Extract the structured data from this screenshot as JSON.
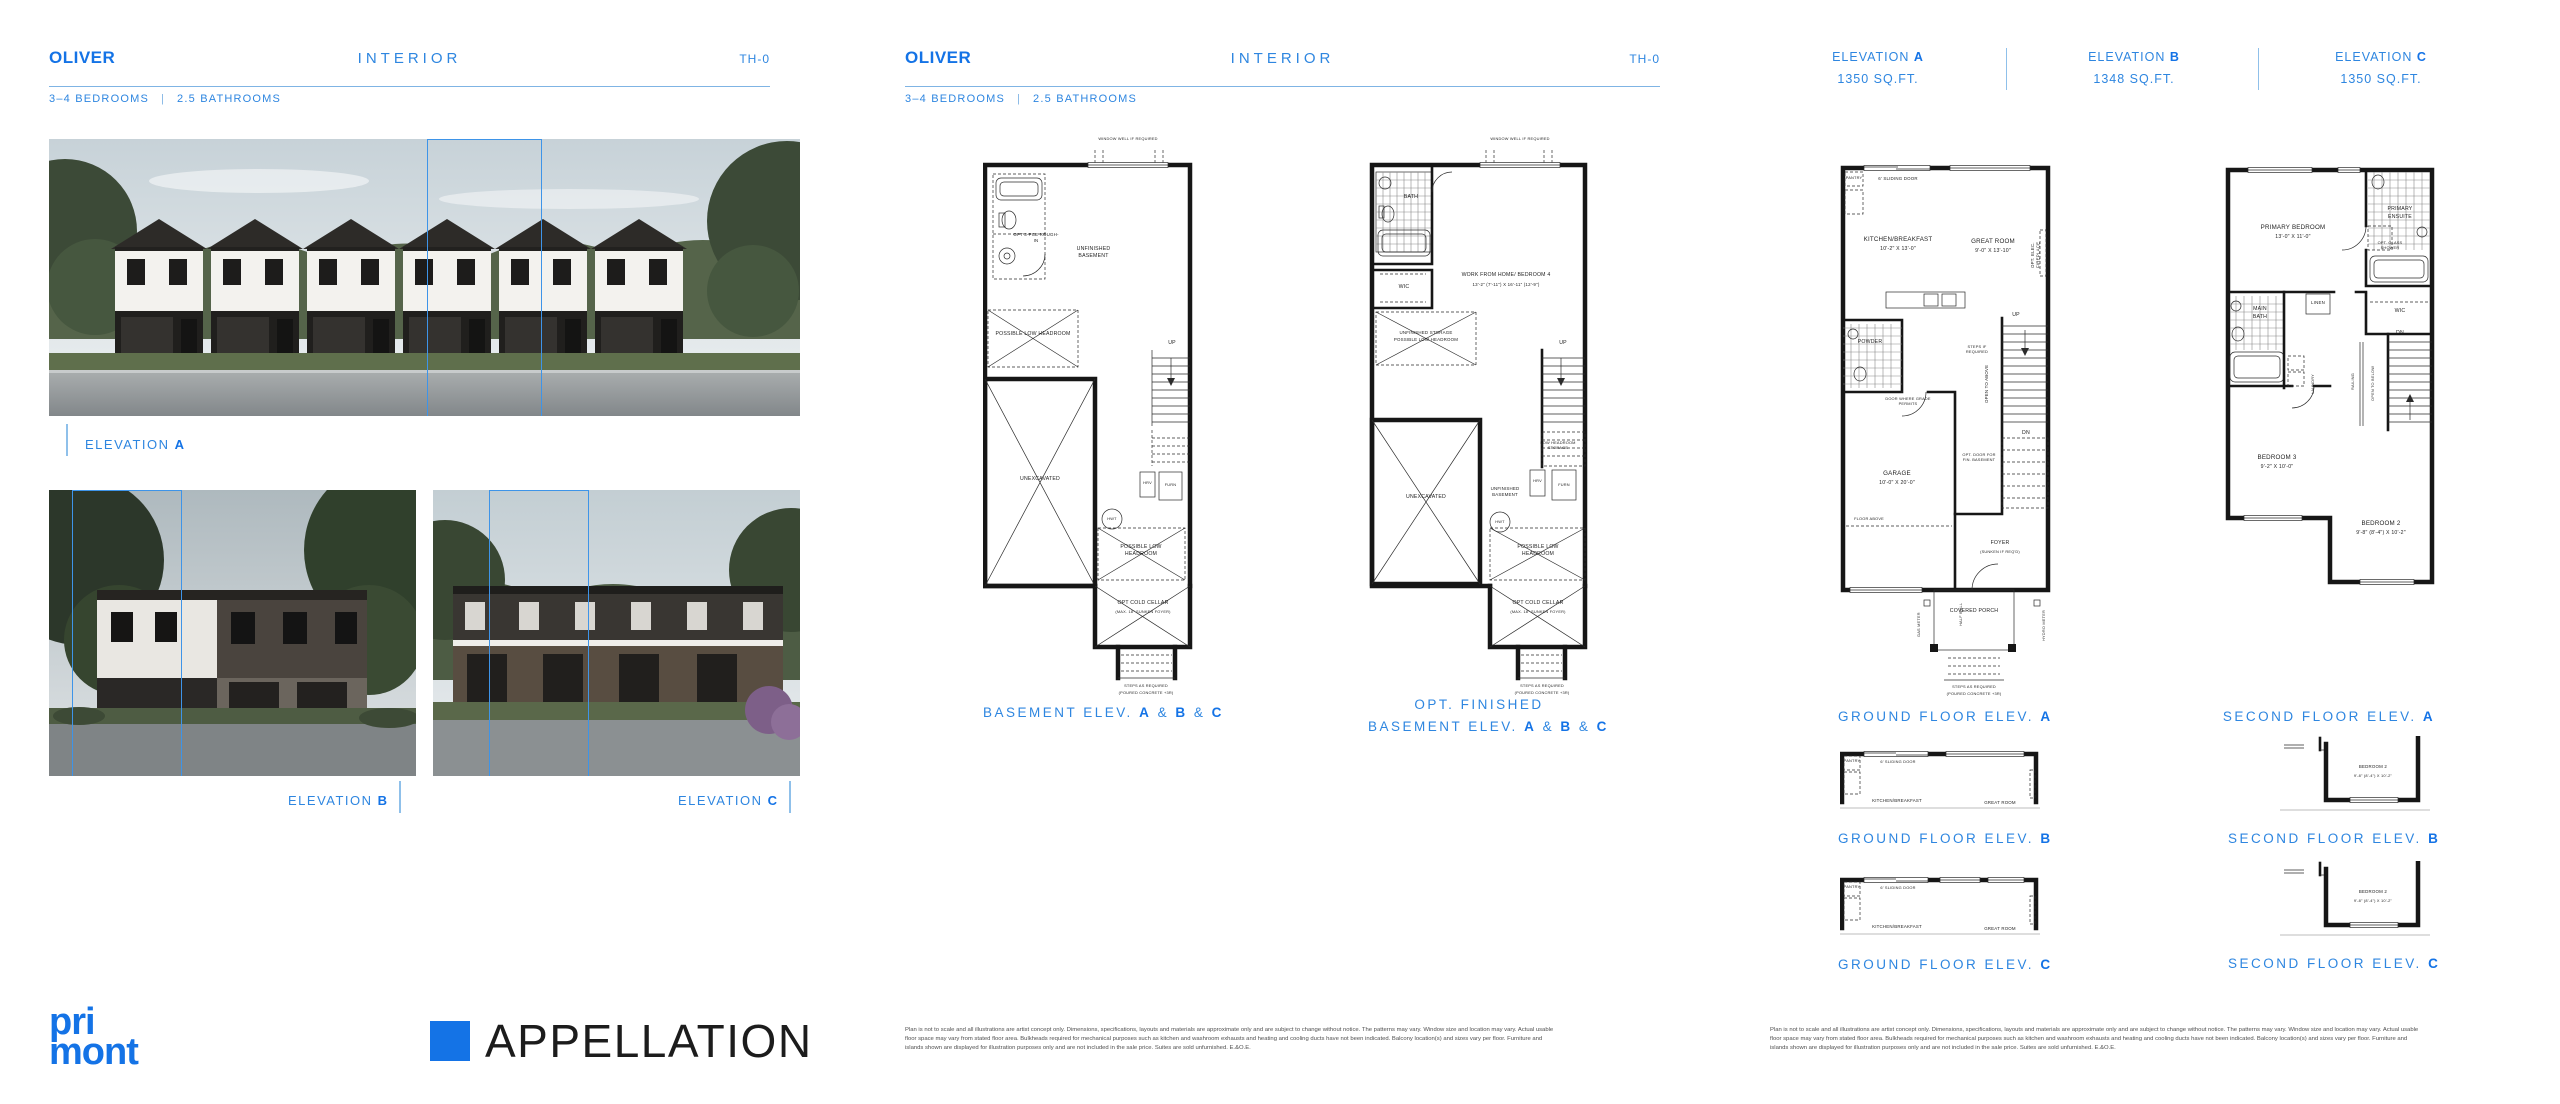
{
  "brand": {
    "accent": "#1473E6",
    "mid_blue": "#2E86E0",
    "light_blue": "#7FB4E4",
    "name_line1": "pri",
    "name_line2": "mont",
    "project": "APPELLATION"
  },
  "header": {
    "title": "OLIVER",
    "subtitle": "INTERIOR",
    "code": "TH-0",
    "specs_beds": "3–4 BEDROOMS",
    "specs_sep": "|",
    "specs_baths": "2.5 BATHROOMS"
  },
  "letters": {
    "a": "A",
    "b": "B",
    "c": "C"
  },
  "elevation_labels": {
    "prefix": "ELEVATION",
    "interior_tag": "INTERIOR"
  },
  "sqft_header": {
    "a": "1350 SQ.FT.",
    "b": "1348 SQ.FT.",
    "c": "1350 SQ.FT."
  },
  "captions": {
    "basement_pre": "BASEMENT ELEV.",
    "opt_line1": "OPT. FINISHED",
    "ground_pre": "GROUND FLOOR ELEV.",
    "second_pre": "SECOND FLOOR ELEV.",
    "amp": "&"
  },
  "basement_plan": {
    "window_well": "WINDOW WELL IF REQUIRED",
    "rough_in": "OPT 3-PCE ROUGH-IN",
    "unfinished": "UNFINISHED BASEMENT",
    "low_headroom": "POSSIBLE LOW HEADROOM",
    "unexcavated": "UNEXCAVATED",
    "hrv": "HRV",
    "furn": "FURN",
    "hwt": "HWT",
    "up": "UP",
    "cold_cellar": "OPT COLD CELLAR",
    "cold_cellar_sub": "(MAX. 18\" SUNKEN FOYER)",
    "steps": "STEPS AS REQUIRED",
    "steps_sub": "(POURED CONCRETE +3R)"
  },
  "finished_basement_plan": {
    "window_well": "WINDOW WELL IF REQUIRED",
    "bath": "BATH",
    "wfh": "WORK FROM HOME/ BEDROOM 4",
    "wfh_dims": "13'-2\" (7'-11\") X 16'-11\" (12'-9\")",
    "wic": "WIC",
    "storage_line1": "UNFINISHED STORAGE",
    "storage_line2": "POSSIBLE LOW HEADROOM",
    "unexcavated": "UNEXCAVATED",
    "low_headroom_storage": "LOW HEADROOM STORAGE",
    "unfinished": "UNFINISHED BASEMENT",
    "hrv": "HRV",
    "furn": "FURN",
    "hwt": "HWT",
    "up": "UP",
    "low_headroom": "POSSIBLE LOW HEADROOM",
    "cold_cellar": "OPT COLD CELLAR",
    "cold_cellar_sub": "(MAX. 18\" SUNKEN FOYER)",
    "steps": "STEPS AS REQUIRED",
    "steps_sub": "(POURED CONCRETE +3R)"
  },
  "ground_plan": {
    "pantry": "PANTRY",
    "sliding_door": "6' SLIDING DOOR",
    "kitchen": "KITCHEN/BREAKFAST",
    "kitchen_dims": "10'-2\" X 13'-0\"",
    "great_room": "GREAT ROOM",
    "great_room_dims": "9'-0\" X 13'-10\"",
    "fireplace": "OPT. ELEC. FIREPLACE",
    "powder": "POWDER",
    "steps_if_required": "STEPS IF REQUIRED",
    "door_grade": "DOOR WHERE GRADE PERMITS",
    "open_above": "OPEN TO ABOVE",
    "up": "UP",
    "dn": "DN",
    "opt_door": "OPT. DOOR FOR FIN. BASEMENT",
    "garage": "GARAGE",
    "garage_dims": "10'-0\" X 20'-0\"",
    "floor_above": "FLOOR ABOVE",
    "foyer": "FOYER",
    "foyer_sub": "(SUNKEN IF REQ'D)",
    "porch": "COVERED PORCH",
    "gas_meter": "GAS METER",
    "half_wall": "HALF WALL",
    "hydro_meter": "HYDRO METER",
    "steps": "STEPS AS REQUIRED",
    "steps_sub": "(POURED CONCRETE +3R)"
  },
  "second_plan": {
    "primary": "PRIMARY BEDROOM",
    "primary_dims": "13'-0\" X 11'-0\"",
    "ensuite_line1": "PRIMARY",
    "ensuite_line2": "ENSUITE",
    "glass_shower": "OPT. GLASS SHOWER",
    "main_bath_line1": "MAIN",
    "main_bath_line2": "BATH",
    "linen": "LINEN",
    "wic": "WIC",
    "laundry": "LAUNDRY",
    "railing": "RAILING",
    "open_below": "OPEN TO BELOW",
    "dn": "DN",
    "bedroom3": "BEDROOM 3",
    "bedroom3_dims": "9'-2\" X 10'-0\"",
    "bedroom2": "BEDROOM 2",
    "bedroom2_dims": "9'-8\" (8'-4\")  X 10'-2\""
  },
  "disclaimer": "Plan is not to scale and all illustrations are artist concept only. Dimensions, specifications, layouts and materials are approximate only and are subject to change without notice. The patterns may vary. Window size and location may vary. Actual usable floor space may vary from stated floor area. Bulkheads required for mechanical purposes such as kitchen and washroom exhausts and heating and cooling ducts have not been indicated. Balcony location(s) and sizes vary per floor. Furniture and islands shown are displayed for illustration purposes only and are not included in the sale price. Suites are sold unfurnished. E.&O.E."
}
